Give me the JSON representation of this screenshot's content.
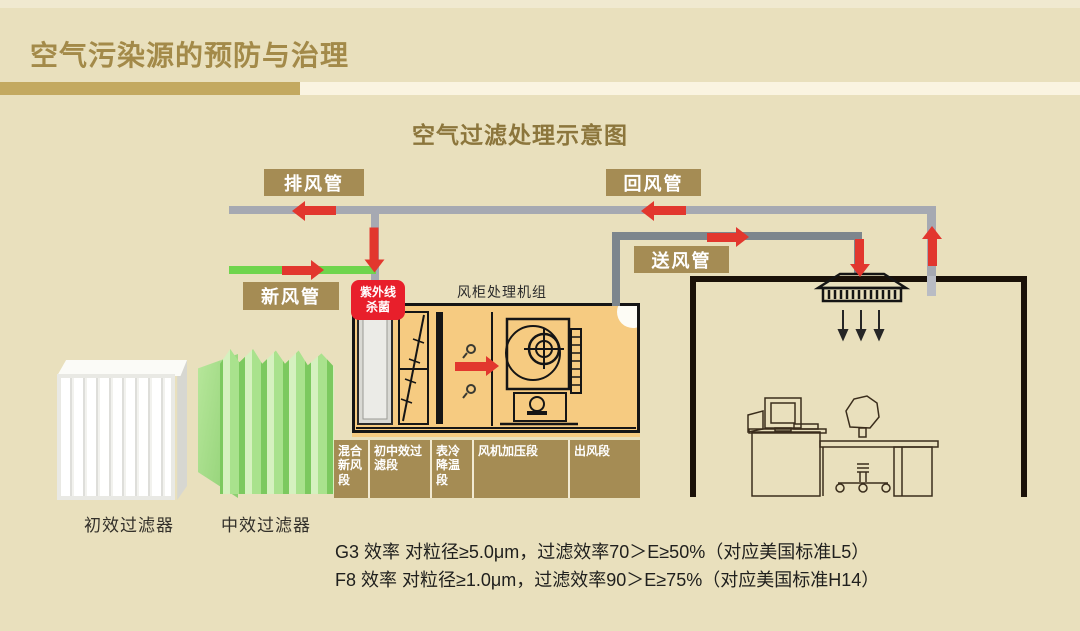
{
  "slide": {
    "title": "空气污染源的预防与治理",
    "subtitle": "空气过滤处理示意图"
  },
  "diagram": {
    "ducts": {
      "exhaust": "排风管",
      "return": "回风管",
      "supply": "送风管",
      "fresh": "新风管"
    },
    "uv": {
      "line1": "紫外线",
      "line2": "杀菌"
    },
    "ahu_title": "风柜处理机组",
    "sections": [
      "混合新风段",
      "初中效过滤段",
      "表冷降温段",
      "风机加压段",
      "出风段"
    ],
    "filters": [
      {
        "name": "初效过滤器"
      },
      {
        "name": "中效过滤器"
      }
    ],
    "notes": [
      "G3 效率 对粒径≥5.0μm，过滤效率70＞E≥50%（对应美国标准L5）",
      "F8 效率 对粒径≥1.0μm，过滤效率90＞E≥75%（对应美国标准H14）"
    ],
    "colors": {
      "background": "#e9e0bd",
      "gold_label": "#a58c54",
      "title_gold": "#a38a49",
      "accent_red": "#e2372e",
      "uv_red": "#e81f2b",
      "fresh_green": "#6fd54d",
      "duct_gray": "#a6a9b2",
      "supply_duct_gray": "#7d868d",
      "ahu_fill": "#f6cb81",
      "wall_black": "#1a1108"
    }
  }
}
